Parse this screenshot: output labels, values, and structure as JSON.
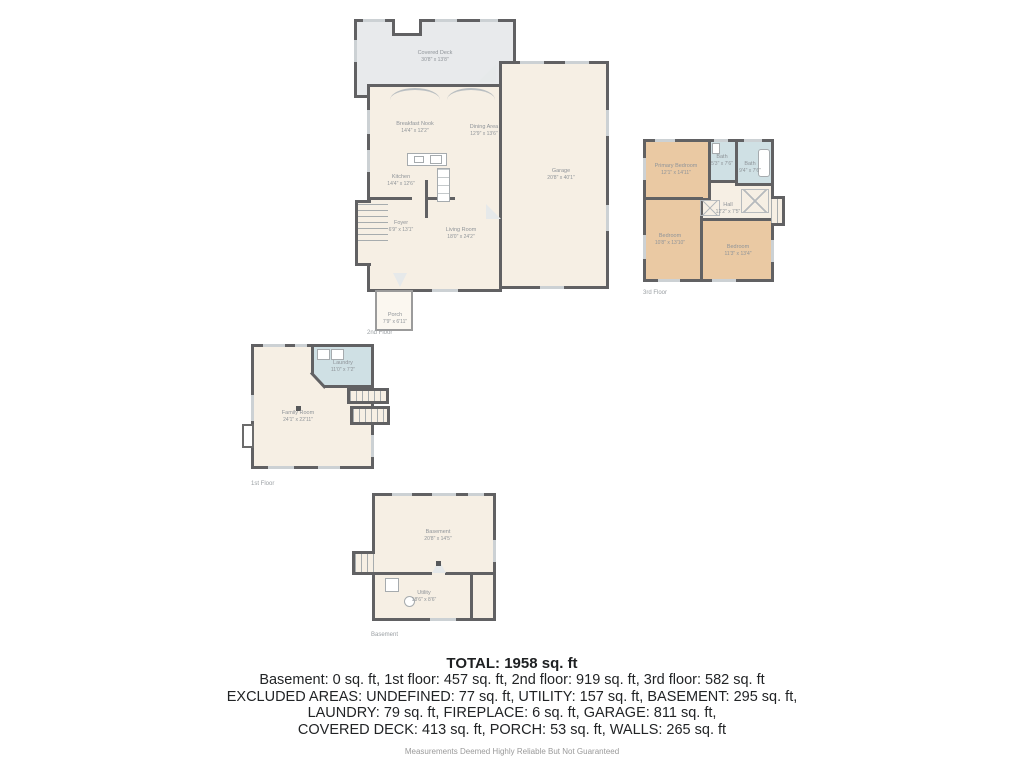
{
  "colors": {
    "wall": "#616163",
    "floor_cream": "#f6efe4",
    "deck_gray": "#e8eaec",
    "wet_blue": "#cfe0e4",
    "bedroom_tan": "#eac9a3"
  },
  "floor2": {
    "caption": "2nd Floor",
    "rooms": {
      "covered_deck": {
        "name": "Covered Deck",
        "dims": "30'8\" x 13'8\""
      },
      "breakfast_nook": {
        "name": "Breakfast Nook",
        "dims": "14'4\" x 12'2\""
      },
      "dining_area": {
        "name": "Dining Area",
        "dims": "12'9\" x 13'6\""
      },
      "kitchen": {
        "name": "Kitchen",
        "dims": "14'4\" x 12'6\""
      },
      "foyer": {
        "name": "Foyer",
        "dims": "6'9\" x 13'1\""
      },
      "living_room": {
        "name": "Living Room",
        "dims": "18'0\" x 24'2\""
      },
      "garage": {
        "name": "Garage",
        "dims": "20'8\" x 40'1\""
      },
      "porch": {
        "name": "Porch",
        "dims": "7'9\" x 6'11\""
      }
    }
  },
  "floor3": {
    "caption": "3rd Floor",
    "rooms": {
      "primary_bedroom": {
        "name": "Primary Bedroom",
        "dims": "12'1\" x 14'11\""
      },
      "bath_small": {
        "name": "Bath",
        "dims": "5'3\" x 7'6\""
      },
      "bath_large": {
        "name": "Bath",
        "dims": "9'4\" x 7'6\""
      },
      "hall": {
        "name": "Hall",
        "dims": "12'2\" x 7'5\""
      },
      "bedroom_left": {
        "name": "Bedroom",
        "dims": "10'8\" x 13'10\""
      },
      "bedroom_right": {
        "name": "Bedroom",
        "dims": "11'3\" x 13'4\""
      }
    }
  },
  "floor1": {
    "caption": "1st Floor",
    "rooms": {
      "laundry": {
        "name": "Laundry",
        "dims": "11'0\" x 7'2\""
      },
      "family_room": {
        "name": "Family Room",
        "dims": "24'1\" x 22'11\""
      }
    }
  },
  "basement_floor": {
    "caption": "Basement",
    "rooms": {
      "basement": {
        "name": "Basement",
        "dims": "20'8\" x 14'5\""
      },
      "utility": {
        "name": "Utility",
        "dims": "18'6\" x 8'6\""
      }
    }
  },
  "summary": {
    "total": "TOTAL: 1958 sq. ft",
    "line1": "Basement: 0 sq. ft, 1st floor: 457 sq. ft, 2nd floor: 919 sq. ft, 3rd floor: 582 sq. ft",
    "line2": "EXCLUDED AREAS: UNDEFINED: 77 sq. ft, UTILITY: 157 sq. ft, BASEMENT: 295 sq. ft,",
    "line3": "LAUNDRY: 79 sq. ft, FIREPLACE: 6 sq. ft, GARAGE: 811 sq. ft,",
    "line4": "COVERED DECK: 413 sq. ft, PORCH: 53 sq. ft, WALLS: 265 sq. ft",
    "disclaimer": "Measurements Deemed Highly Reliable But Not Guaranteed"
  }
}
